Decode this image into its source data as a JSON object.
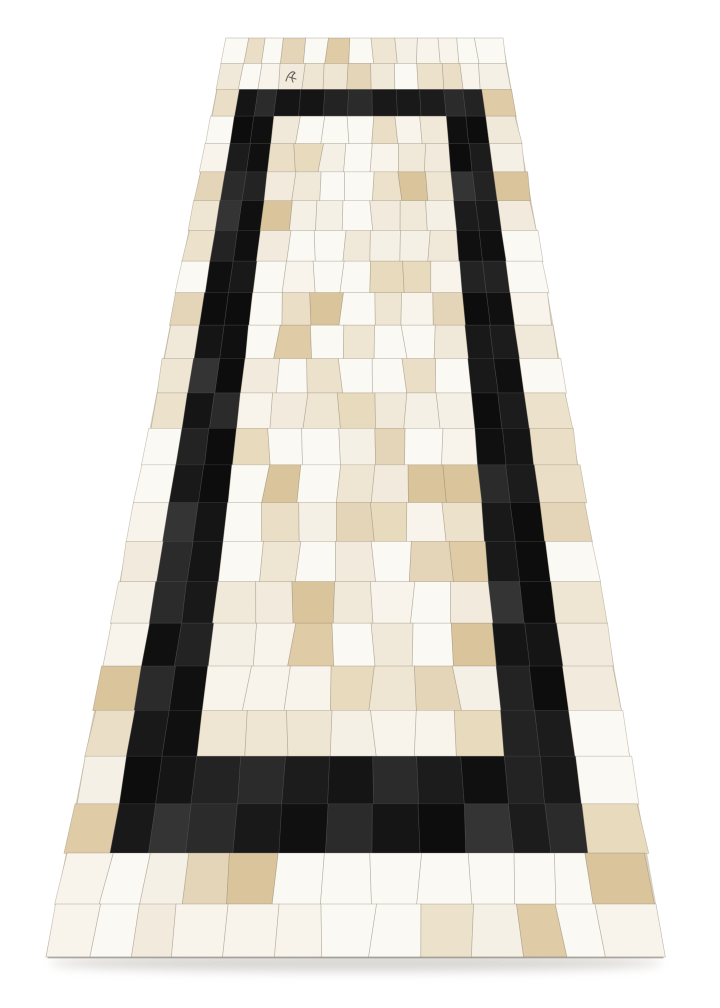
{
  "meta": {
    "description": "Product photograph of a black and ivory cowhide patchwork runner rug shown in perspective on a plain white background",
    "background_color": "#ffffff"
  },
  "rug": {
    "geometry": {
      "top_y": 38,
      "bottom_y": 957,
      "top_width": 276,
      "bottom_width": 620,
      "center_x_top": 364.5,
      "center_x_bottom": 355.5,
      "persp_b": 0.4675
    },
    "grid": {
      "cols": 13,
      "rows": 25,
      "col_weights": [
        0.95,
        0.8,
        0.8,
        1,
        1,
        1,
        1,
        1,
        1,
        1,
        0.8,
        0.8,
        1.25
      ],
      "frame": {
        "top_bar_row": 2,
        "bottom_bar_rows": [
          21,
          22
        ],
        "side_cols": [
          1,
          2,
          10,
          11
        ],
        "span_cols": [
          1,
          11
        ]
      }
    },
    "palette": {
      "creams": [
        "#fbf9f4",
        "#f8f4ec",
        "#f5f0e5",
        "#f2ebdd",
        "#eee5d2",
        "#eadec7",
        "#e5d5b8",
        "#dfcba6",
        "#f0e9da",
        "#ece2cb",
        "#e8dabd",
        "#d9c49c"
      ],
      "cream_bias": 1.9,
      "blacks": [
        "#151515",
        "#1c1c1c",
        "#101010",
        "#232323",
        "#191919",
        "#2b2b2b",
        "#0d0d0d",
        "#343434"
      ],
      "seam_cream": "rgba(139,127,106,0.42)",
      "seam_black": "rgba(82,82,82,0.45)",
      "backing": "#d8d0c0"
    },
    "jitter": {
      "cream": 0.1,
      "black": 0.02,
      "edge": 0.05,
      "seed": 1337
    },
    "edge_line": {
      "color": "#7d786f",
      "width": 1.6,
      "opacity": 0.55
    }
  },
  "shadow": {
    "color": "#cfccc7",
    "cx": 356,
    "cy": 963,
    "rx": 306,
    "ry": 8.5,
    "blur": 5,
    "opacity": 0.8
  },
  "marking": {
    "path": "M286 81 C 288 73, 293 70, 295 73 C 292 75, 291 78, 293 82 M289 77 L 296 79",
    "color": "#4a463f",
    "stroke_width": 1.1
  }
}
